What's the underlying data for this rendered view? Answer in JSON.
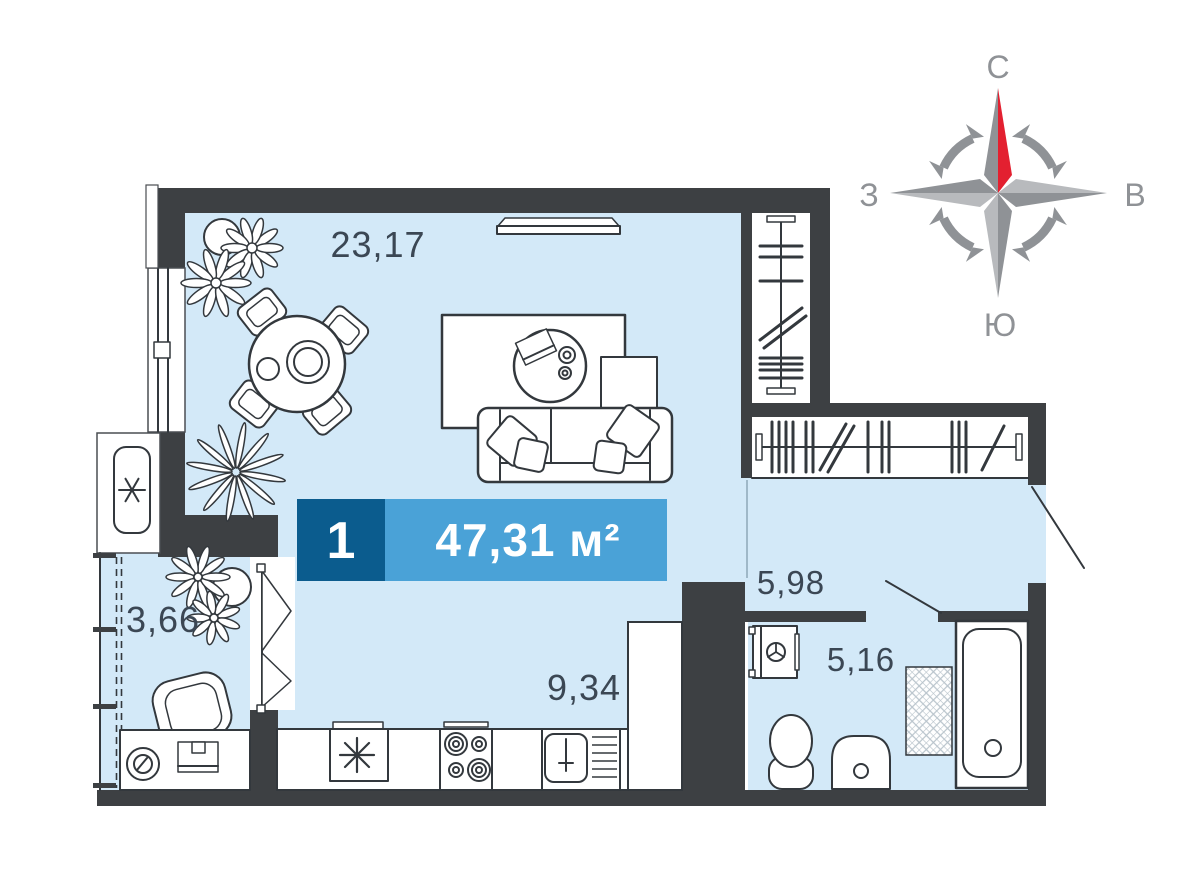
{
  "colors": {
    "wall": "#3d4043",
    "room_fill": "#d3e9f8",
    "line": "#33383d",
    "label": "#3b4754",
    "badge_dark": "#0b5c8e",
    "badge_light": "#4aa2d7",
    "badge_text": "#ffffff",
    "compass_gray": "#8f9296",
    "compass_gray_light": "#b8babd",
    "compass_red": "#e32030",
    "zone_line": "#9fb8c8",
    "hatch": "#b9c4cc"
  },
  "unit_badge": {
    "room_count": "1",
    "area": "47,31 м²"
  },
  "room_labels": {
    "living": "23,17",
    "balcony": "3,66",
    "kitchen": "9,34",
    "hallway": "5,98",
    "bathroom": "5,16"
  },
  "compass": {
    "north": "С",
    "east": "В",
    "south": "Ю",
    "west": "З"
  }
}
